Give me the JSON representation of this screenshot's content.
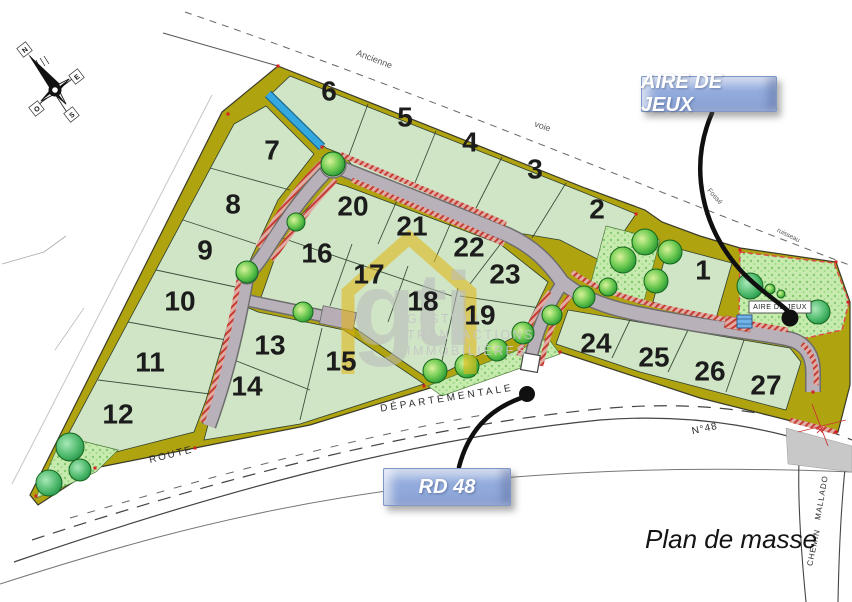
{
  "page": {
    "title": "Plan de masse"
  },
  "callouts": {
    "playground": "AIRE DE JEUX",
    "road": "RD 48"
  },
  "map_labels": {
    "playground_box": "AIRE DE JEUX",
    "route": "ROUTE",
    "departementale": "DÉPARTEMENTALE",
    "road_number": "N°48",
    "chemin": "CHEMIN",
    "chemin_name": "MALLADO",
    "old_way_word1": "Ancienne",
    "old_way_word2": "voie",
    "ditch": "Fossé",
    "stream": "ruisseau"
  },
  "compass": {
    "north": "N",
    "east": "E",
    "south": "S",
    "west": "O"
  },
  "watermark": {
    "logo": "gti",
    "line1": "GESTION",
    "line2": "TRANSACTIONS",
    "line3": "IMMOBILIÈRES"
  },
  "lots": [
    {
      "number": "1"
    },
    {
      "number": "2"
    },
    {
      "number": "3"
    },
    {
      "number": "4"
    },
    {
      "number": "5"
    },
    {
      "number": "6"
    },
    {
      "number": "7"
    },
    {
      "number": "8"
    },
    {
      "number": "9"
    },
    {
      "number": "10"
    },
    {
      "number": "11"
    },
    {
      "number": "12"
    },
    {
      "number": "13"
    },
    {
      "number": "14"
    },
    {
      "number": "15"
    },
    {
      "number": "16"
    },
    {
      "number": "17"
    },
    {
      "number": "18"
    },
    {
      "number": "19"
    },
    {
      "number": "20"
    },
    {
      "number": "21"
    },
    {
      "number": "22"
    },
    {
      "number": "23"
    },
    {
      "number": "24"
    },
    {
      "number": "25"
    },
    {
      "number": "26"
    },
    {
      "number": "27"
    }
  ],
  "colors": {
    "lot_green": "#cfe5c5",
    "band_olive": "#b0a310",
    "road_gray": "#b9b1b9",
    "callout_blue": "#8fa9db",
    "tree_green": "#3fae3c",
    "hatch_red": "#c43c32",
    "water_blue": "#35a8e0",
    "marker_red": "#d22222"
  }
}
